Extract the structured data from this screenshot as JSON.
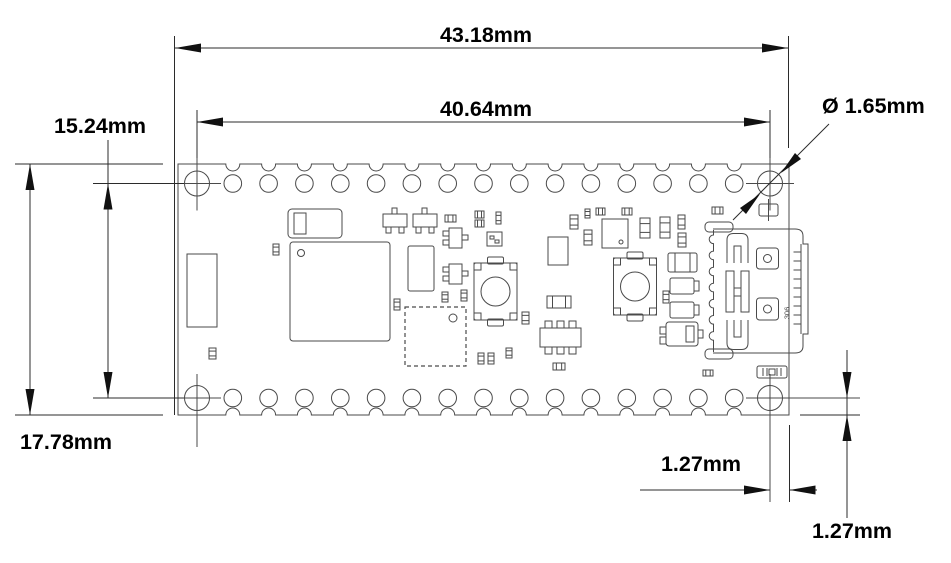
{
  "dimensions": {
    "overall_width": "43.18mm",
    "pin_row_span": "40.64mm",
    "hole_row_span": "15.24mm",
    "overall_height": "17.78mm",
    "hole_diameter": "Ø 1.65mm",
    "hole_offset_horizontal": "1.27mm",
    "hole_offset_vertical": "1.27mm"
  },
  "usb_connector": {
    "marking": "306"
  },
  "colors": {
    "line": "#4a4a4a",
    "dimension": "#2b2b2b",
    "text": "#000000",
    "background": "#ffffff"
  }
}
